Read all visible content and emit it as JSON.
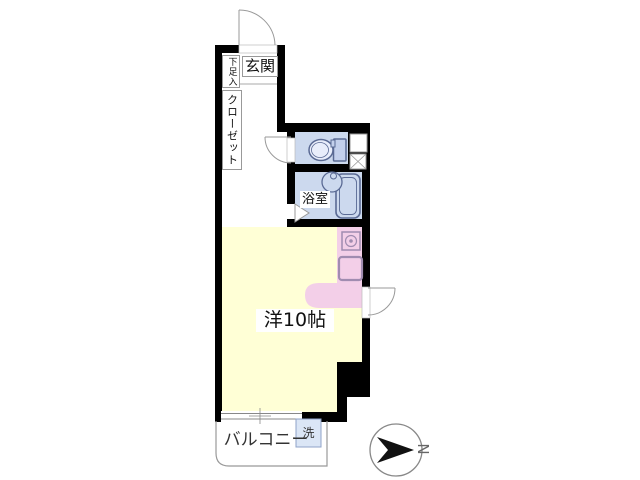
{
  "floorplan": {
    "labels": {
      "entrance": "玄関",
      "shoe_storage": "下足入",
      "closet": "クローゼット",
      "bathroom": "浴室",
      "main_room": "洋10帖",
      "balcony": "バルコニー",
      "washer": "洗",
      "compass_north": "N"
    },
    "colors": {
      "wall": "#000000",
      "wet_area_fill": "#ccd9ee",
      "fixture_outline": "#5a6a94",
      "room_fill": "#ffffd6",
      "kitchen_fill": "#f3cfe8",
      "kitchen_outline": "#a08cb0",
      "thin_line": "#999999",
      "washer_fill": "#dbe6f6"
    }
  }
}
